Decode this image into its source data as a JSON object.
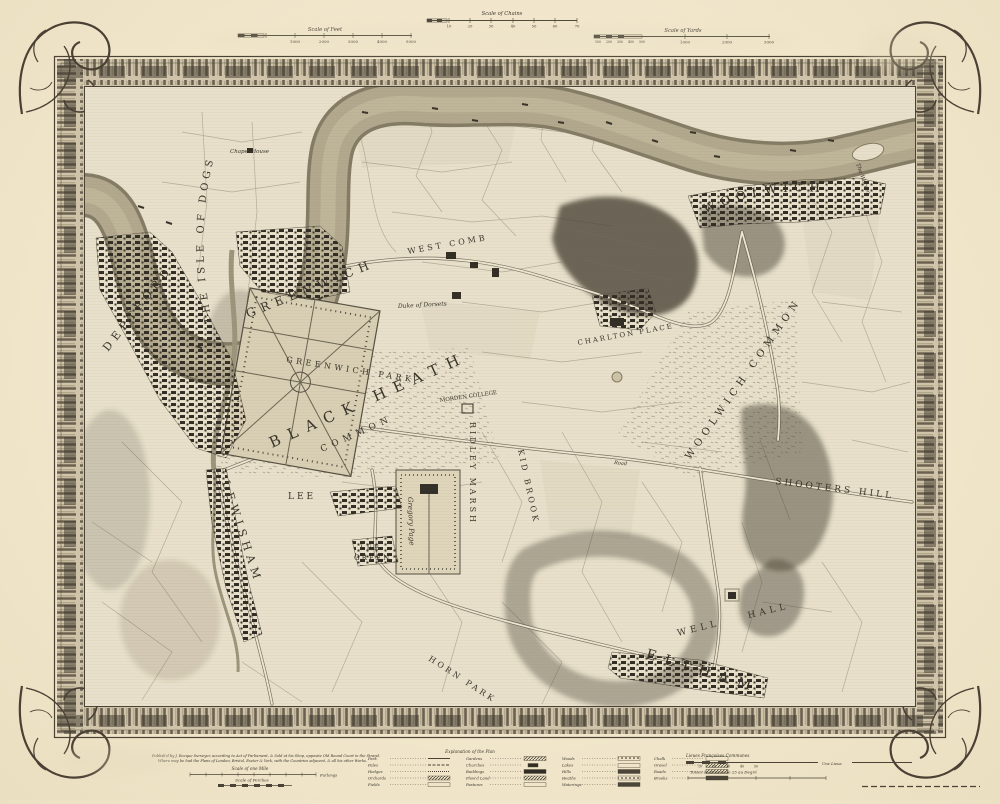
{
  "colors": {
    "paper": "#f2e8cf",
    "ink": "#3b362c",
    "river": "#b2a88d",
    "frame": "#4a4336",
    "wood": "#4c463a"
  },
  "scales": {
    "feet": {
      "title": "Scale of Feet",
      "ticks": [
        "1000",
        "2000",
        "3000",
        "4000",
        "5000"
      ]
    },
    "chains": {
      "title": "Scale of Chains",
      "ticks": [
        "10",
        "20",
        "30",
        "40",
        "50",
        "60",
        "70"
      ]
    },
    "yards": {
      "title": "Scale of Yards",
      "small_ticks": [
        "100",
        "200",
        "300",
        "400",
        "500"
      ],
      "ticks": [
        "1000",
        "2000",
        "3000"
      ]
    },
    "mile": {
      "title": "Scale of one Mile",
      "unit": "Furlongs"
    },
    "perches": {
      "title": "Scale of Perches"
    },
    "leagues": {
      "title": "Lieues Françoises Communes",
      "ticks": [
        "10",
        "20",
        "30",
        "40",
        "50"
      ],
      "unit": "Une Lieue"
    },
    "toises": {
      "title": "Toises de France de 25 au Degré"
    }
  },
  "imprint": {
    "line1": "Publish'd by J. Rocque Surveyor, according to Act of Parliament, & Sold at his Shop, opposite Old Round Court in the Strand.",
    "line2": "Where may be had the Plans of London, Bristol, Exeter & York, with the Countries adjacent, & all his other Works."
  },
  "legend": {
    "title": "Explanation of the Plan",
    "columns": [
      [
        "Park",
        "Pales",
        "Hedges",
        "Orchards",
        "Fields"
      ],
      [
        "Gardens",
        "Churches",
        "Buildings",
        "Plow'd Land",
        "Pastures"
      ],
      [
        "Woods",
        "Lakes",
        "Hills",
        "Heaths",
        "Waterings"
      ],
      [
        "Chalk",
        "Gravel",
        "Roads",
        "Brooks"
      ]
    ]
  },
  "map_labels": [
    {
      "text": "THE ISLE OF DOGS"
    },
    {
      "text": "Chapel House"
    },
    {
      "text": "DEPTFORD"
    },
    {
      "text": "GREENWICH"
    },
    {
      "text": "GREENWICH PARK"
    },
    {
      "text": "WEST COMB"
    },
    {
      "text": "Duke of Dorsets"
    },
    {
      "text": "BLACK HEATH"
    },
    {
      "text": "COMMON"
    },
    {
      "text": "CHARLTON PLACE"
    },
    {
      "text": "WOOLWICH"
    },
    {
      "text": "The Warren"
    },
    {
      "text": "WOOLWICH COMMON"
    },
    {
      "text": "SHOOTERS HILL"
    },
    {
      "text": "MORDEN COLLEGE"
    },
    {
      "text": "RIDLEY MARSH"
    },
    {
      "text": "KID BROOK"
    },
    {
      "text": "LEE"
    },
    {
      "text": "LEE"
    },
    {
      "text": "GREEN"
    },
    {
      "text": "Gregory Page"
    },
    {
      "text": "LEWISHAM"
    },
    {
      "text": "HORN PARK"
    },
    {
      "text": "WELL HALL"
    },
    {
      "text": "ELTHAM"
    },
    {
      "text": "Road"
    }
  ]
}
